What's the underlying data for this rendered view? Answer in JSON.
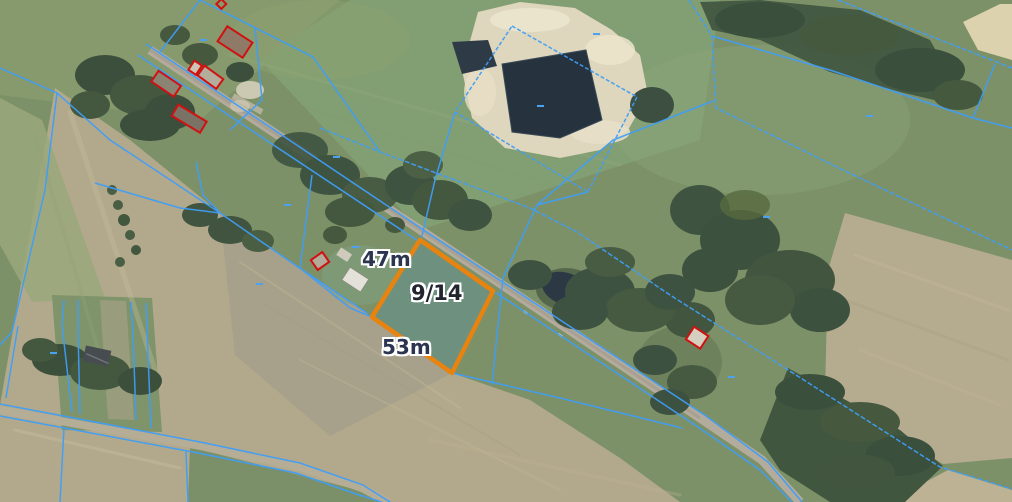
{
  "map": {
    "view": "aerial cadastral map",
    "labels": {
      "parcel_number": "9/14",
      "dimension_top": "47m",
      "dimension_bottom": "53m"
    },
    "colors": {
      "parcel_boundary_blue": "#3f9ef7",
      "building_outline_red": "#d01111",
      "highlight_orange": "#e8830f",
      "highlight_fill": "#6d9181"
    },
    "features": [
      "highlighted-parcel",
      "main-road",
      "secondary-road",
      "sand-pit",
      "excavation-pond",
      "field-pond",
      "forest-strips",
      "farmstead-building-outlines"
    ]
  }
}
